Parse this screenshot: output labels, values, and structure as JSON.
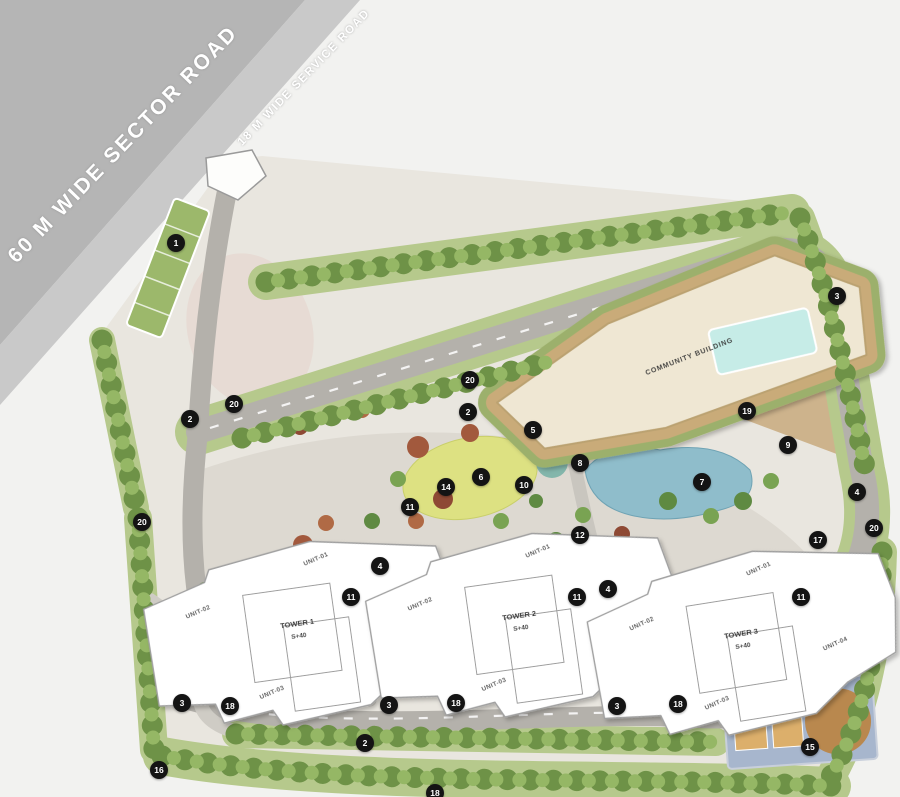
{
  "site_plan": {
    "roads": {
      "sector_road_label": "60 M WIDE SECTOR ROAD",
      "service_road_label": "18 M WIDE SERVICE ROAD"
    },
    "community_building_label": "COMMUNITY BUILDING",
    "towers": [
      {
        "name": "TOWER 1",
        "floors": "S+40",
        "units": [
          "UNIT-01",
          "UNIT-02",
          "UNIT-03",
          "UNIT-04"
        ]
      },
      {
        "name": "TOWER 2",
        "floors": "S+40",
        "units": [
          "UNIT-01",
          "UNIT-02",
          "UNIT-03",
          "UNIT-04"
        ]
      },
      {
        "name": "TOWER 3",
        "floors": "S+40",
        "units": [
          "UNIT-01",
          "UNIT-02",
          "UNIT-03",
          "UNIT-04"
        ]
      }
    ],
    "markers": [
      {
        "n": "1",
        "x": 176,
        "y": 243
      },
      {
        "n": "2",
        "x": 190,
        "y": 419
      },
      {
        "n": "20",
        "x": 234,
        "y": 404
      },
      {
        "n": "20",
        "x": 470,
        "y": 380
      },
      {
        "n": "2",
        "x": 468,
        "y": 412
      },
      {
        "n": "5",
        "x": 533,
        "y": 430
      },
      {
        "n": "3",
        "x": 837,
        "y": 296
      },
      {
        "n": "19",
        "x": 747,
        "y": 411
      },
      {
        "n": "9",
        "x": 788,
        "y": 445
      },
      {
        "n": "8",
        "x": 580,
        "y": 463
      },
      {
        "n": "6",
        "x": 481,
        "y": 477
      },
      {
        "n": "14",
        "x": 446,
        "y": 487
      },
      {
        "n": "10",
        "x": 524,
        "y": 485
      },
      {
        "n": "7",
        "x": 702,
        "y": 482
      },
      {
        "n": "4",
        "x": 857,
        "y": 492
      },
      {
        "n": "20",
        "x": 874,
        "y": 528
      },
      {
        "n": "20",
        "x": 142,
        "y": 522
      },
      {
        "n": "11",
        "x": 410,
        "y": 507
      },
      {
        "n": "12",
        "x": 580,
        "y": 535
      },
      {
        "n": "17",
        "x": 818,
        "y": 540
      },
      {
        "n": "4",
        "x": 380,
        "y": 566
      },
      {
        "n": "11",
        "x": 351,
        "y": 597
      },
      {
        "n": "4",
        "x": 608,
        "y": 589
      },
      {
        "n": "11",
        "x": 577,
        "y": 597
      },
      {
        "n": "11",
        "x": 801,
        "y": 597
      },
      {
        "n": "3",
        "x": 182,
        "y": 703
      },
      {
        "n": "18",
        "x": 230,
        "y": 706
      },
      {
        "n": "3",
        "x": 389,
        "y": 705
      },
      {
        "n": "18",
        "x": 456,
        "y": 703
      },
      {
        "n": "2",
        "x": 365,
        "y": 743
      },
      {
        "n": "3",
        "x": 617,
        "y": 706
      },
      {
        "n": "18",
        "x": 678,
        "y": 704
      },
      {
        "n": "15",
        "x": 810,
        "y": 747
      },
      {
        "n": "16",
        "x": 159,
        "y": 770
      },
      {
        "n": "18",
        "x": 435,
        "y": 793
      }
    ],
    "colors": {
      "marker_bg": "#141414",
      "marker_text": "#ffffff",
      "sector_road": "#b5b5b5",
      "service_road": "#c9c9c9",
      "road_label": "#ffffff",
      "internal_road": "#b4b1ab",
      "water": "#8fbdcb",
      "pool": "#c6ece7",
      "building_roof": "#efe7d3",
      "tower_fill": "#ffffff",
      "lawn": "#dde182"
    }
  }
}
